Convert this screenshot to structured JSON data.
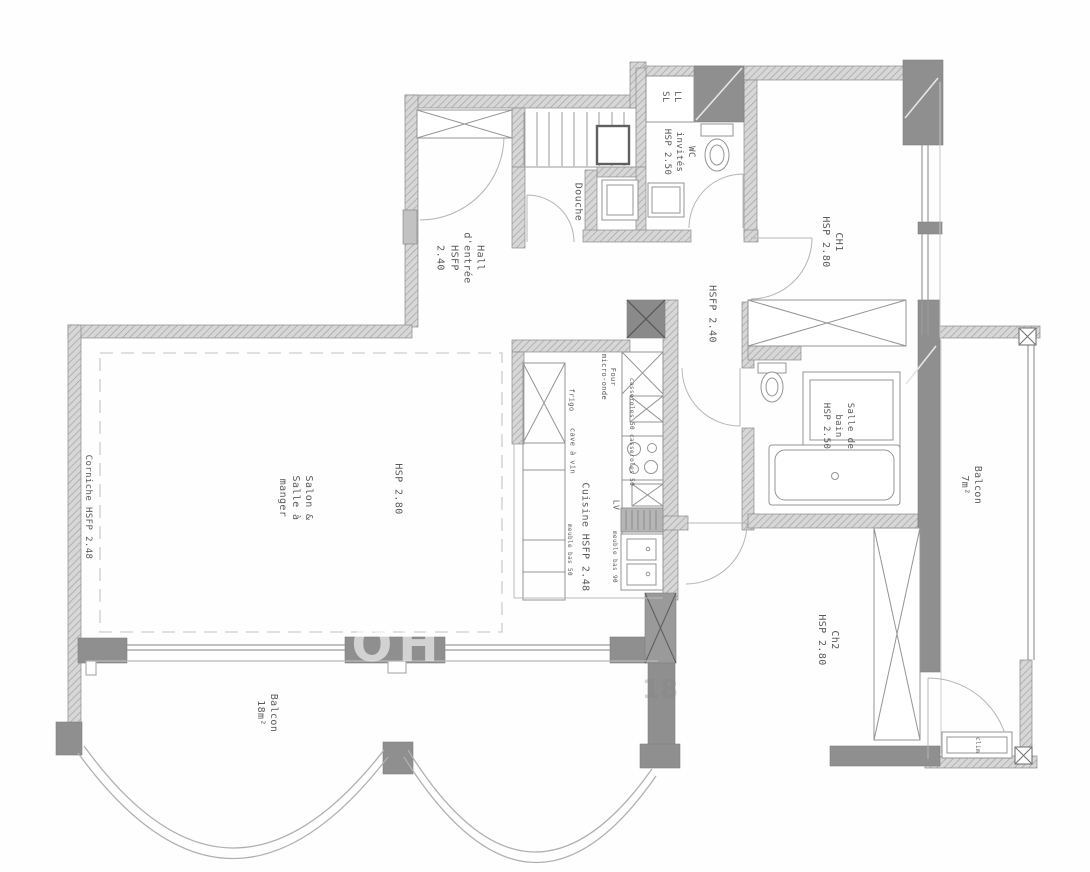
{
  "plan": {
    "colors": {
      "wall_hatch_bg": "#d7d7d7",
      "wall_hatch_line": "#a3a3a3",
      "wall_solid": "#8f8f8f",
      "fixture_line": "#949494",
      "door_line": "#b5b5b5",
      "text": "#5a5a5a"
    },
    "labels": [
      {
        "id": "hall",
        "text": "Hall\nd'entrée\nHSFP\n2.40"
      },
      {
        "id": "douche",
        "text": "Douche"
      },
      {
        "id": "wc",
        "text": "WC\ninvités\nHSP 2.50"
      },
      {
        "id": "ll-sl",
        "text": "LL\nSL"
      },
      {
        "id": "ch1",
        "text": "CH1\nHSP 2.80"
      },
      {
        "id": "hallway",
        "text": "HSFP 2.40"
      },
      {
        "id": "sdb",
        "text": "Salle de\nbain\nHSP 2.50"
      },
      {
        "id": "salon",
        "text": "Salon &\nSalle à\nmanger"
      },
      {
        "id": "salon-hsp",
        "text": "HSP 2.80"
      },
      {
        "id": "cuisine",
        "text": "Cuisine HSFP 2.48"
      },
      {
        "id": "corniche",
        "text": "Corniche HSFP 2.48"
      },
      {
        "id": "balcon18",
        "text": "Balcon\n18m²"
      },
      {
        "id": "ch2",
        "text": "Ch2\nHSP 2.80"
      },
      {
        "id": "balcon7",
        "text": "Balcon\n7m²"
      },
      {
        "id": "clim",
        "text": "clim"
      },
      {
        "id": "frigo",
        "text": "frigo"
      },
      {
        "id": "cave-a-vin",
        "text": "cave à vin"
      },
      {
        "id": "meuble-bas-50",
        "text": "meuble bas 50"
      },
      {
        "id": "four-micro-onde",
        "text": "Four\nmicro-onde"
      },
      {
        "id": "casseroles",
        "text": "casseroles 50 casseroles 50"
      },
      {
        "id": "lv",
        "text": "LV"
      },
      {
        "id": "meuble-bas-90",
        "text": "meuble bas 90"
      }
    ],
    "watermarks": [
      {
        "id": "wm-oh",
        "text": "OH"
      },
      {
        "id": "wm-18",
        "text": "18"
      }
    ]
  }
}
